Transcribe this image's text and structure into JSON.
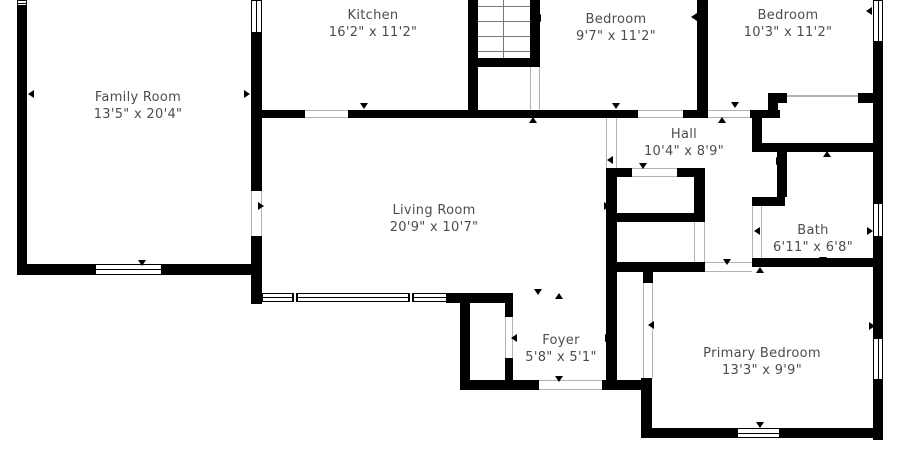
{
  "colors": {
    "wall": "#000000",
    "label_text": "#4d4d4d",
    "door_jamb": "#b3b3b3",
    "background": "#ffffff"
  },
  "rooms": [
    {
      "id": "family-room",
      "name": "Family Room",
      "dims": "13'5\" x 20'4\"",
      "cx": 138,
      "cy": 106
    },
    {
      "id": "kitchen",
      "name": "Kitchen",
      "dims": "16'2\" x 11'2\"",
      "cx": 373,
      "cy": 24
    },
    {
      "id": "bedroom-1",
      "name": "Bedroom",
      "dims": "9'7\" x 11'2\"",
      "cx": 616,
      "cy": 28
    },
    {
      "id": "bedroom-2",
      "name": "Bedroom",
      "dims": "10'3\" x 11'2\"",
      "cx": 788,
      "cy": 24
    },
    {
      "id": "hall",
      "name": "Hall",
      "dims": "10'4\" x 8'9\"",
      "cx": 684,
      "cy": 143
    },
    {
      "id": "living-room",
      "name": "Living Room",
      "dims": "20'9\" x 10'7\"",
      "cx": 434,
      "cy": 219
    },
    {
      "id": "bath",
      "name": "Bath",
      "dims": "6'11\" x 6'8\"",
      "cx": 813,
      "cy": 239
    },
    {
      "id": "foyer",
      "name": "Foyer",
      "dims": "5'8\" x 5'1\"",
      "cx": 561,
      "cy": 349
    },
    {
      "id": "primary-bedroom",
      "name": "Primary Bedroom",
      "dims": "13'3\" x 9'9\"",
      "cx": 762,
      "cy": 362
    }
  ],
  "floorplan": {
    "walls": [
      [
        17,
        0,
        10,
        275
      ],
      [
        17,
        264,
        245,
        11
      ],
      [
        251,
        33,
        11,
        158
      ],
      [
        251,
        236,
        11,
        68
      ],
      [
        262,
        110,
        43,
        8
      ],
      [
        348,
        110,
        130,
        8
      ],
      [
        468,
        0,
        10,
        118
      ],
      [
        530,
        0,
        10,
        60
      ],
      [
        468,
        58,
        72,
        9
      ],
      [
        478,
        110,
        160,
        8
      ],
      [
        683,
        110,
        25,
        8
      ],
      [
        750,
        110,
        30,
        8
      ],
      [
        697,
        0,
        11,
        118
      ],
      [
        873,
        42,
        10,
        161
      ],
      [
        873,
        237,
        10,
        101
      ],
      [
        873,
        380,
        10,
        60
      ],
      [
        768,
        93,
        19,
        10
      ],
      [
        858,
        93,
        15,
        10
      ],
      [
        768,
        93,
        10,
        25
      ],
      [
        752,
        110,
        10,
        42
      ],
      [
        752,
        143,
        131,
        9
      ],
      [
        777,
        152,
        10,
        45
      ],
      [
        752,
        197,
        33,
        9
      ],
      [
        752,
        258,
        123,
        9
      ],
      [
        606,
        168,
        11,
        215
      ],
      [
        606,
        168,
        99,
        9
      ],
      [
        694,
        168,
        11,
        54
      ],
      [
        606,
        213,
        99,
        9
      ],
      [
        606,
        262,
        99,
        10
      ],
      [
        643,
        272,
        10,
        11
      ],
      [
        446,
        293,
        67,
        10
      ],
      [
        460,
        293,
        10,
        97
      ],
      [
        505,
        295,
        8,
        22
      ],
      [
        505,
        358,
        8,
        32
      ],
      [
        460,
        380,
        79,
        10
      ],
      [
        602,
        380,
        50,
        10
      ],
      [
        641,
        378,
        11,
        60
      ],
      [
        641,
        428,
        242,
        10
      ]
    ],
    "windows": [
      {
        "x": 17,
        "y": 0,
        "w": 10,
        "h": 6,
        "o": "h"
      },
      {
        "x": 95,
        "y": 264,
        "w": 67,
        "h": 11,
        "o": "h"
      },
      {
        "x": 251,
        "y": 0,
        "w": 11,
        "h": 33,
        "o": "v"
      },
      {
        "x": 262,
        "y": 293,
        "w": 185,
        "h": 9,
        "o": "h",
        "mullions": [
          291,
          407
        ]
      },
      {
        "x": 873,
        "y": 0,
        "w": 10,
        "h": 42,
        "o": "v"
      },
      {
        "x": 873,
        "y": 203,
        "w": 10,
        "h": 34,
        "o": "v"
      },
      {
        "x": 873,
        "y": 338,
        "w": 10,
        "h": 42,
        "o": "v"
      },
      {
        "x": 737,
        "y": 428,
        "w": 43,
        "h": 10,
        "o": "h"
      }
    ],
    "doors": [
      {
        "x": 305,
        "y": 110,
        "w": 43,
        "h": 8,
        "o": "h"
      },
      {
        "x": 530,
        "y": 67,
        "w": 10,
        "h": 43,
        "o": "v"
      },
      {
        "x": 638,
        "y": 110,
        "w": 45,
        "h": 8,
        "o": "h"
      },
      {
        "x": 708,
        "y": 110,
        "w": 42,
        "h": 8,
        "o": "h"
      },
      {
        "x": 251,
        "y": 191,
        "w": 11,
        "h": 45,
        "o": "v"
      },
      {
        "x": 752,
        "y": 206,
        "w": 10,
        "h": 52,
        "o": "v"
      },
      {
        "x": 694,
        "y": 222,
        "w": 11,
        "h": 40,
        "o": "v"
      },
      {
        "x": 632,
        "y": 168,
        "w": 45,
        "h": 9,
        "o": "h"
      },
      {
        "x": 505,
        "y": 317,
        "w": 8,
        "h": 41,
        "o": "v"
      },
      {
        "x": 643,
        "y": 283,
        "w": 10,
        "h": 95,
        "o": "v"
      },
      {
        "x": 705,
        "y": 262,
        "w": 47,
        "h": 10,
        "o": "h"
      },
      {
        "x": 539,
        "y": 380,
        "w": 63,
        "h": 10,
        "o": "h"
      },
      {
        "x": 606,
        "y": 118,
        "w": 11,
        "h": 50,
        "o": "v"
      }
    ],
    "markers": [
      {
        "d": "left",
        "x": 28,
        "y": 90
      },
      {
        "d": "right",
        "x": 244,
        "y": 90
      },
      {
        "d": "down",
        "x": 360,
        "y": 103
      },
      {
        "d": "left",
        "x": 535,
        "y": 14
      },
      {
        "d": "up",
        "x": 529,
        "y": 117
      },
      {
        "d": "down",
        "x": 612,
        "y": 103
      },
      {
        "d": "up",
        "x": 718,
        "y": 117
      },
      {
        "d": "down",
        "x": 731,
        "y": 102
      },
      {
        "d": "left",
        "x": 691,
        "y": 13
      },
      {
        "d": "up",
        "x": 698,
        "y": 4
      },
      {
        "d": "left",
        "x": 866,
        "y": 7
      },
      {
        "d": "down",
        "x": 138,
        "y": 260
      },
      {
        "d": "left",
        "x": 607,
        "y": 156
      },
      {
        "d": "right",
        "x": 604,
        "y": 202
      },
      {
        "d": "right",
        "x": 258,
        "y": 202
      },
      {
        "d": "down",
        "x": 639,
        "y": 163
      },
      {
        "d": "down",
        "x": 534,
        "y": 289
      },
      {
        "d": "up",
        "x": 555,
        "y": 293
      },
      {
        "d": "left",
        "x": 511,
        "y": 334
      },
      {
        "d": "right",
        "x": 605,
        "y": 334
      },
      {
        "d": "left",
        "x": 648,
        "y": 321
      },
      {
        "d": "down",
        "x": 555,
        "y": 376
      },
      {
        "d": "up",
        "x": 823,
        "y": 151
      },
      {
        "d": "right",
        "x": 776,
        "y": 157
      },
      {
        "d": "left",
        "x": 754,
        "y": 227
      },
      {
        "d": "right",
        "x": 867,
        "y": 227
      },
      {
        "d": "down",
        "x": 819,
        "y": 257
      },
      {
        "d": "up",
        "x": 756,
        "y": 267
      },
      {
        "d": "down",
        "x": 723,
        "y": 259
      },
      {
        "d": "down",
        "x": 756,
        "y": 422
      },
      {
        "d": "right",
        "x": 869,
        "y": 322
      }
    ],
    "stairs": {
      "x": 478,
      "y": 0,
      "w": 52,
      "h": 58,
      "treads": [
        6,
        21,
        36,
        51
      ],
      "divider_x": 503
    },
    "lines": [
      {
        "x": 787,
        "y": 95,
        "w": 71,
        "h": 1.5
      }
    ]
  }
}
